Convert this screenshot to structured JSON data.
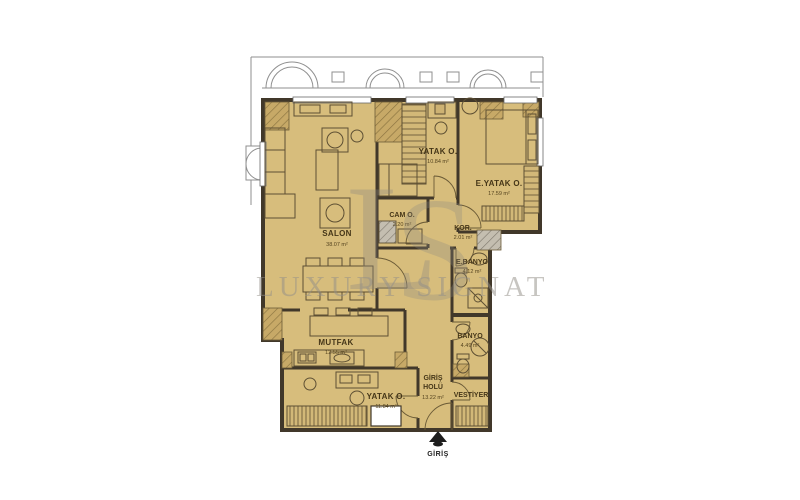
{
  "watermark": {
    "monogram_left": "L",
    "monogram_right": "S",
    "text": "LUXURY SIGNATU"
  },
  "entrance": {
    "label": "GİRİŞ"
  },
  "rooms": [
    {
      "id": "salon",
      "name": "SALON",
      "area": "38.07 m²"
    },
    {
      "id": "yatak-odasi",
      "name": "YATAK O.",
      "area": "10.84 m²"
    },
    {
      "id": "ebeveyn-yatak-odasi",
      "name": "E.YATAK O.",
      "area": "17.59 m²"
    },
    {
      "id": "camasir-odasi",
      "name": "CAM O.",
      "area": "2.20 m²"
    },
    {
      "id": "koridor",
      "name": "KOR.",
      "area": "2.01 m²"
    },
    {
      "id": "ebeveyn-banyo",
      "name": "E.BANYO",
      "area": "4.12 m²"
    },
    {
      "id": "banyo",
      "name": "BANYO",
      "area": "4.49 m²"
    },
    {
      "id": "mutfak",
      "name": "MUTFAK",
      "area": "12.55 m²"
    },
    {
      "id": "giris-holu",
      "name_line1": "GİRİŞ",
      "name_line2": "HOLÜ",
      "area": "13.22 m²"
    },
    {
      "id": "vestiyer",
      "name": "VESTİYER"
    },
    {
      "id": "yatak-odasi-2",
      "name": "YATAK O.",
      "area": "11.84 m²"
    }
  ],
  "colors": {
    "floor": "#d7bd7c",
    "wall": "#41382a",
    "furniture": "#5d4f33",
    "watermark_gray": "#948f88"
  }
}
